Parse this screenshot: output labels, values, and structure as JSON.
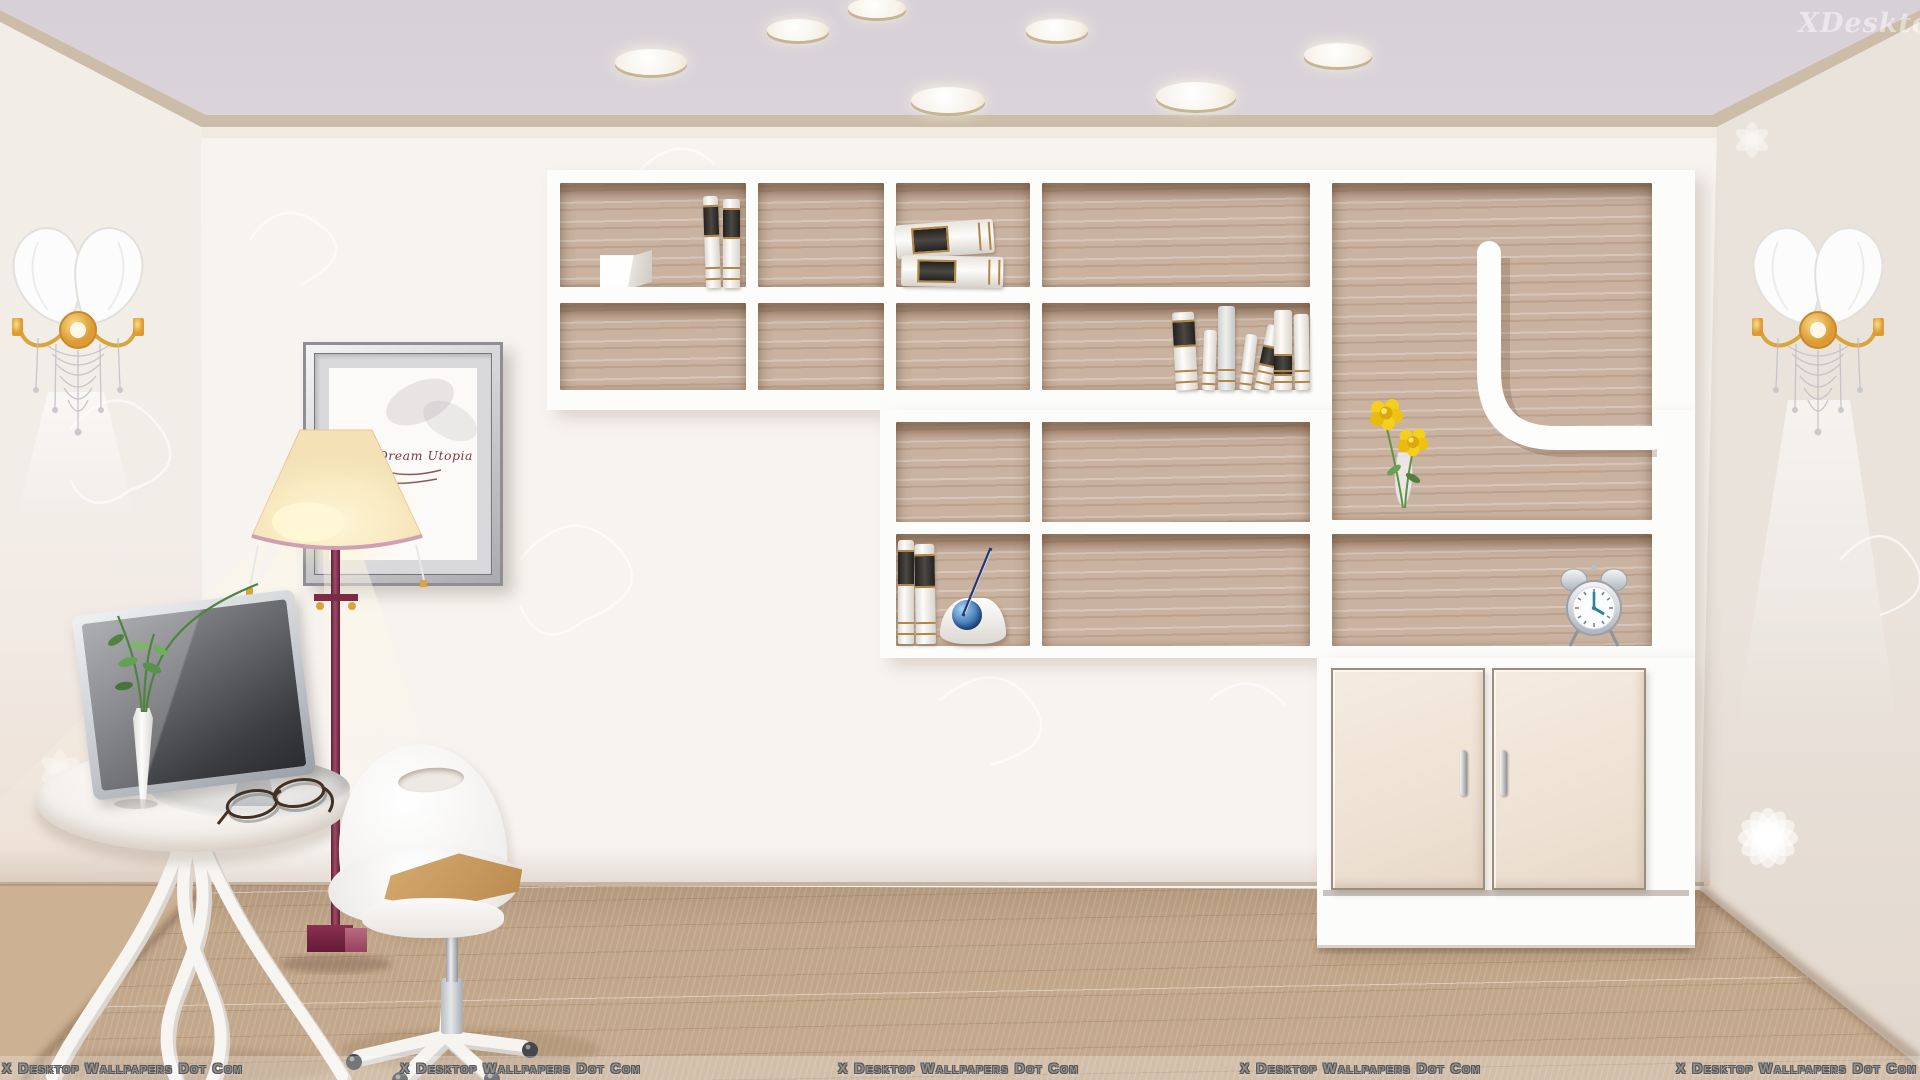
{
  "watermarks": {
    "text": "X Desktop Wallpapers Dot Com",
    "bottom_positions_x": [
      2,
      400,
      838,
      1240,
      1676
    ],
    "top_right_text": "XDesktop"
  },
  "picture_frame": {
    "caption": "ital Dream Utopia"
  },
  "clock": {
    "time_shown": "4:00"
  },
  "scene": {
    "type": "vector-illustration-wallpaper",
    "setting": "cream home study with wall shelf unit, floor lamp, monitor table and swivel chair",
    "objects": [
      "ceiling-recessed-lights",
      "crown-molding",
      "wall-sconces",
      "wall-shelf-unit",
      "books",
      "storage-cube",
      "pen-holder-with-globe",
      "yellow-flowers-in-vase",
      "alarm-clock",
      "two-door-cabinet",
      "framed-picture",
      "floor-lamp",
      "round-table",
      "computer-monitor",
      "plant-sprig-vase",
      "reading-glasses",
      "swivel-chair",
      "wood-plank-floor"
    ],
    "ceiling_lights": [
      [
        651,
        62,
        72,
        26
      ],
      [
        798,
        30,
        62,
        22
      ],
      [
        877,
        8,
        58,
        20
      ],
      [
        948,
        100,
        74,
        26
      ],
      [
        1057,
        30,
        62,
        22
      ],
      [
        1196,
        96,
        80,
        28
      ],
      [
        1338,
        55,
        68,
        24
      ]
    ],
    "shelf_cells": [
      [
        560,
        183,
        186,
        104
      ],
      [
        758,
        183,
        126,
        104
      ],
      [
        896,
        183,
        134,
        104
      ],
      [
        1042,
        183,
        268,
        104
      ],
      [
        560,
        303,
        186,
        87
      ],
      [
        758,
        303,
        126,
        87
      ],
      [
        896,
        303,
        134,
        87
      ],
      [
        1042,
        303,
        268,
        87
      ],
      [
        1332,
        183,
        320,
        337
      ],
      [
        896,
        422,
        134,
        100
      ],
      [
        1042,
        422,
        268,
        100
      ],
      [
        896,
        534,
        134,
        112
      ],
      [
        1042,
        534,
        268,
        112
      ],
      [
        1332,
        534,
        320,
        112
      ]
    ],
    "books": [
      {
        "t": "v",
        "x": 706,
        "y": 196,
        "w": 15,
        "h": 92,
        "r": -2,
        "band": "top"
      },
      {
        "t": "v",
        "x": 723,
        "y": 199,
        "w": 17,
        "h": 89,
        "r": 0,
        "band": "top"
      },
      {
        "t": "h",
        "x": 897,
        "y": 222,
        "w": 98,
        "h": 34,
        "r": -4,
        "band": "mid"
      },
      {
        "t": "h",
        "x": 901,
        "y": 256,
        "w": 102,
        "h": 31,
        "r": 1,
        "band": "mid"
      },
      {
        "t": "v",
        "x": 1176,
        "y": 312,
        "w": 22,
        "h": 78,
        "r": -3,
        "band": "top"
      },
      {
        "t": "v",
        "x": 1202,
        "y": 330,
        "w": 13,
        "h": 60,
        "r": 2,
        "band": "none"
      },
      {
        "t": "v",
        "x": 1218,
        "y": 306,
        "w": 17,
        "h": 84,
        "r": 0,
        "band": "none",
        "tone": "gray"
      },
      {
        "t": "v",
        "x": 1239,
        "y": 334,
        "w": 12,
        "h": 56,
        "r": 7,
        "band": "none"
      },
      {
        "t": "v",
        "x": 1254,
        "y": 324,
        "w": 15,
        "h": 66,
        "r": 12,
        "band": "mid"
      },
      {
        "t": "v",
        "x": 1274,
        "y": 310,
        "w": 18,
        "h": 80,
        "r": 0,
        "band": "low"
      },
      {
        "t": "v",
        "x": 1295,
        "y": 314,
        "w": 15,
        "h": 76,
        "r": -1,
        "band": "none"
      },
      {
        "t": "v",
        "x": 898,
        "y": 540,
        "w": 16,
        "h": 104,
        "r": 0,
        "band": "top"
      },
      {
        "t": "v",
        "x": 916,
        "y": 544,
        "w": 20,
        "h": 100,
        "r": -1,
        "band": "top"
      }
    ],
    "colors": {
      "ceiling": "#dbd4da",
      "molding_tan": "#cbbda7",
      "molding_cream": "#f1eae1",
      "wall": "#f7f3ef",
      "wall_left": "#f3ede8",
      "wall_right": "#eae3dc",
      "floor": "#c4a98c",
      "shelf_back": "#c9b2a0",
      "unit_white": "#fcfcfb",
      "door": "#f1e5d9",
      "maroon": "#8c3052",
      "shade": "#f9ecc9",
      "flower": "#f2cf1d",
      "cushion": "#c79759",
      "gold": "#b08747"
    }
  }
}
